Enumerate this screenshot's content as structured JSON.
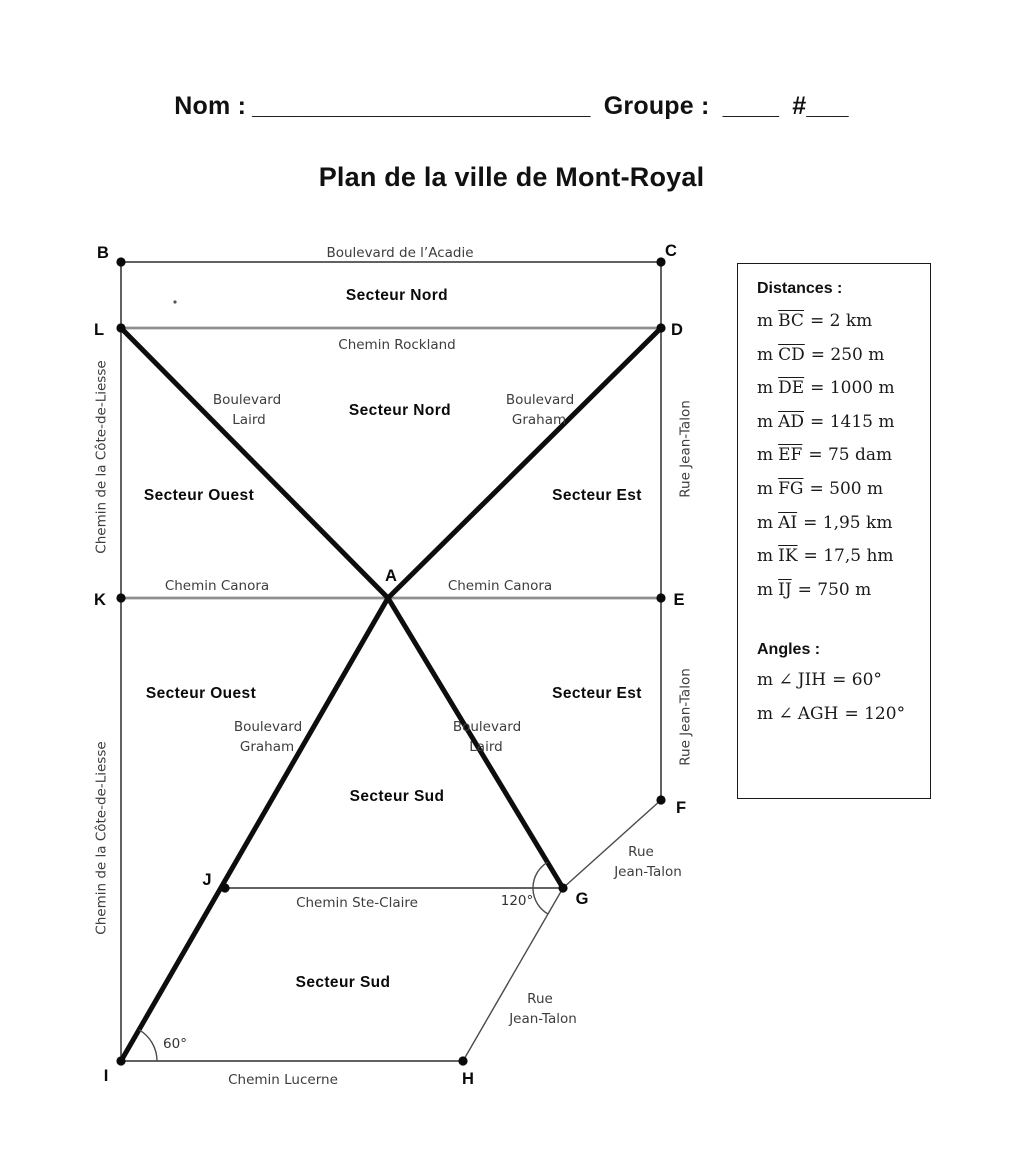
{
  "header": {
    "nom": "Nom :",
    "nom_line": "________________________",
    "groupe": "Groupe :",
    "groupe_line": "____",
    "hash": "#___"
  },
  "title": "Plan de la ville de Mont-Royal",
  "panel": {
    "distances_title": "Distances :",
    "distances": [
      {
        "pre": "m",
        "seg": "BC",
        "val": "= 2 km"
      },
      {
        "pre": "m",
        "seg": "CD",
        "val": "= 250 m"
      },
      {
        "pre": "m",
        "seg": "DE",
        "val": "= 1000 m"
      },
      {
        "pre": "m",
        "seg": "AD",
        "val": "= 1415 m"
      },
      {
        "pre": "m",
        "seg": "EF",
        "val": "= 75 dam"
      },
      {
        "pre": "m",
        "seg": "FG",
        "val": "= 500 m"
      },
      {
        "pre": "m",
        "seg": "AI",
        "val": "= 1,95 km"
      },
      {
        "pre": "m",
        "seg": "IK",
        "val": "= 17,5 hm"
      },
      {
        "pre": "m",
        "seg": "IJ",
        "val": "= 750 m"
      }
    ],
    "angles_title": "Angles :",
    "angles": [
      {
        "pre": "m ∠",
        "name": "JIH",
        "val": "= 60°"
      },
      {
        "pre": "m ∠",
        "name": "AGH",
        "val": "= 120°"
      }
    ]
  },
  "map": {
    "points": {
      "a": "A",
      "b": "B",
      "c": "C",
      "d": "D",
      "e": "E",
      "f": "F",
      "g": "G",
      "h": "H",
      "i": "I",
      "j": "J",
      "k": "K",
      "l": "L"
    },
    "streets": {
      "acadie": "Boulevard de l’Acadie",
      "rockland": "Chemin Rockland",
      "boulevard": "Boulevard",
      "laird": "Laird",
      "graham": "Graham",
      "canora": "Chemin Canora",
      "ste_claire": "Chemin Ste-Claire",
      "lucerne": "Chemin Lucerne",
      "cote_de_liesse": "Chemin de la Côte-de-Liesse",
      "jean_talon": "Rue Jean-Talon",
      "rue": "Rue",
      "jean_talon_2": "Jean-Talon"
    },
    "sectors": {
      "nord": "Secteur Nord",
      "ouest": "Secteur Ouest",
      "est": "Secteur Est",
      "sud": "Secteur Sud"
    },
    "angle_marks": {
      "at_i": "60°",
      "at_g": "120°"
    },
    "colors": {
      "ink": "#0d0d0d",
      "thin_line": "#2e2e2e",
      "gray_road": "#8f8f8f",
      "street_text": "#3d3d3d"
    }
  }
}
